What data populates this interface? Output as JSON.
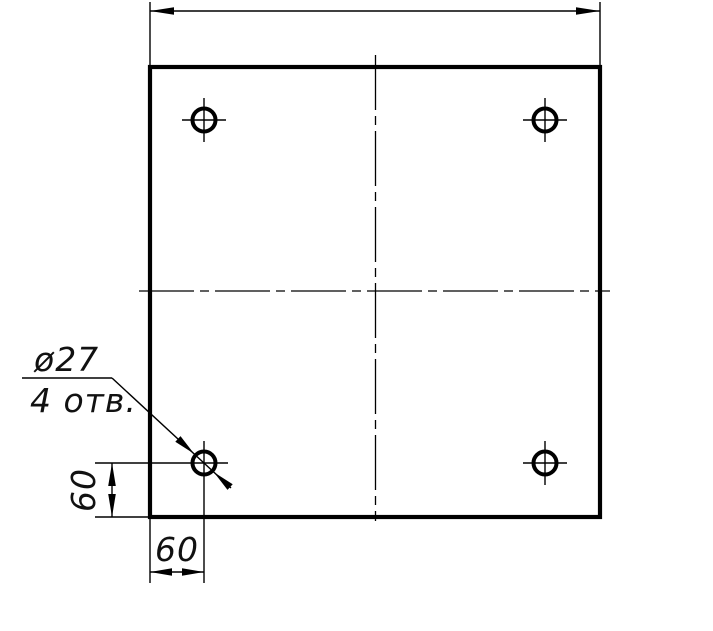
{
  "drawing": {
    "callout": {
      "diameter": "ø27",
      "holes_count": "4 отв."
    },
    "dimensions": {
      "hole_offset_x": "60",
      "hole_offset_y": "60"
    },
    "colors": {
      "line": "#000000",
      "background": "#ffffff"
    }
  }
}
